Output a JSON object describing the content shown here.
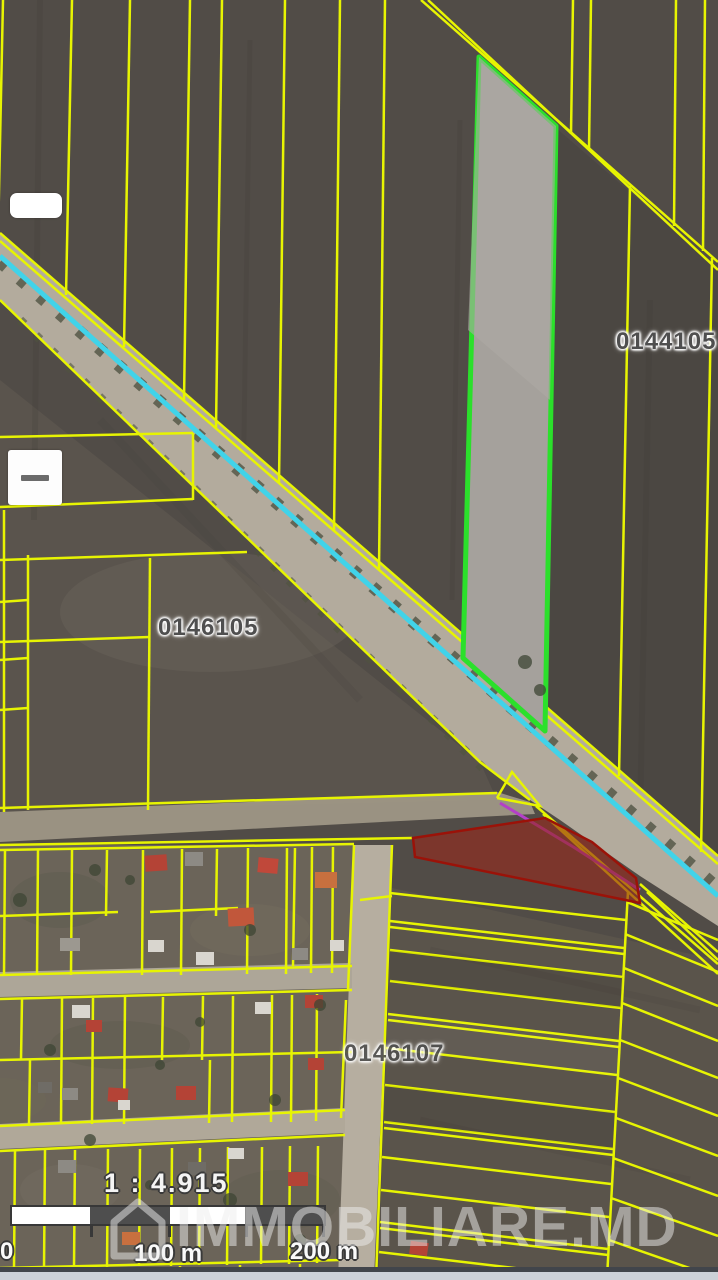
{
  "labels": {
    "sector_top_right": "0144105",
    "sector_mid_left": "0146105",
    "sector_bottom": "0146107"
  },
  "scale": {
    "ratio": "1 : 4.915",
    "zero": "0",
    "hundred": "100 m",
    "two_hundred": "200 m"
  },
  "watermark": {
    "text": "IMMOBILIARE.MD"
  },
  "controls": {
    "zoom_out_glyph": "-"
  },
  "colors": {
    "parcel_line_yellow": "#e7f402",
    "highlight_border_green": "#2be02b",
    "highlight_fill_gray": "#a5a19c",
    "selected_parcel_red_fill": "#8f2418",
    "selected_parcel_red_border": "#9b1208",
    "water_cyan_line": "#41d3e9",
    "boundary_purple": "#b43fc8",
    "road_surface": "#b3ab9d",
    "field_dark": "#514c47"
  }
}
